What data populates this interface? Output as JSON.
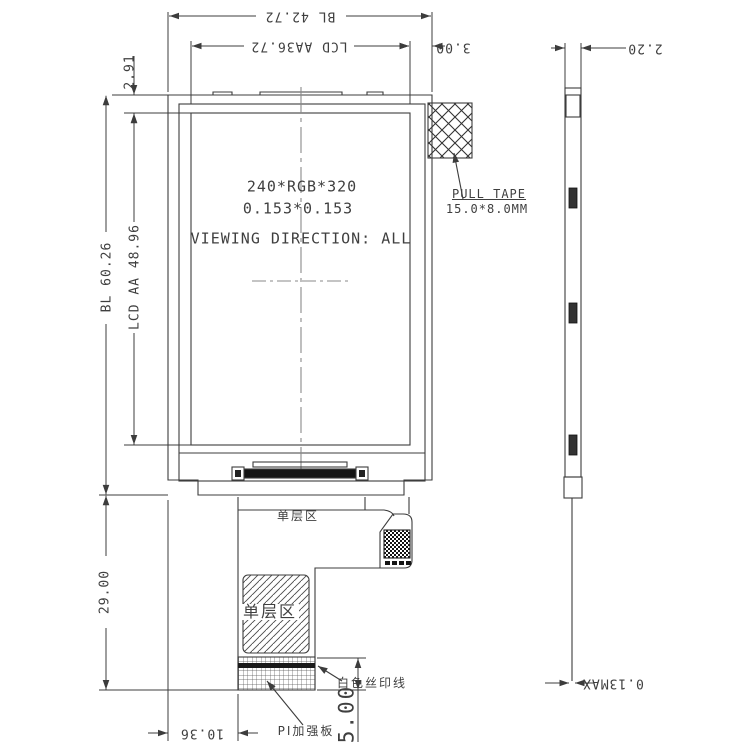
{
  "drawing": {
    "display_area": {
      "resolution": "240*RGB*320",
      "pixel_pitch": "0.153*0.153",
      "viewing_direction": "VIEWING DIRECTION: ALL"
    },
    "callouts": {
      "pull_tape": "PULL TAPE",
      "pull_tape_size": "15.0*8.0MM",
      "single_layer_upper": "单层区",
      "single_layer_lower": "单层区",
      "white_silkscreen_line": "白色丝印线",
      "pi_stiffener": "PI加强板"
    },
    "dimensions": {
      "bl_width": "BL 42.72",
      "aa_width": "LCD AA36.72",
      "side_margin": "3.00",
      "top_margin": "2.91",
      "bl_height": "BL 60.26",
      "aa_height": "LCD AA 48.96",
      "fpc_length": "29.00",
      "tail_offset": "10.36",
      "pi_height": "5.00",
      "module_thickness": "2.20",
      "fpc_thickness": "0.13MAX"
    },
    "colors": {
      "line": "#3c3c3c",
      "text": "#3f3f3f",
      "dark_fill": "#151515",
      "background": "#ffffff"
    }
  }
}
